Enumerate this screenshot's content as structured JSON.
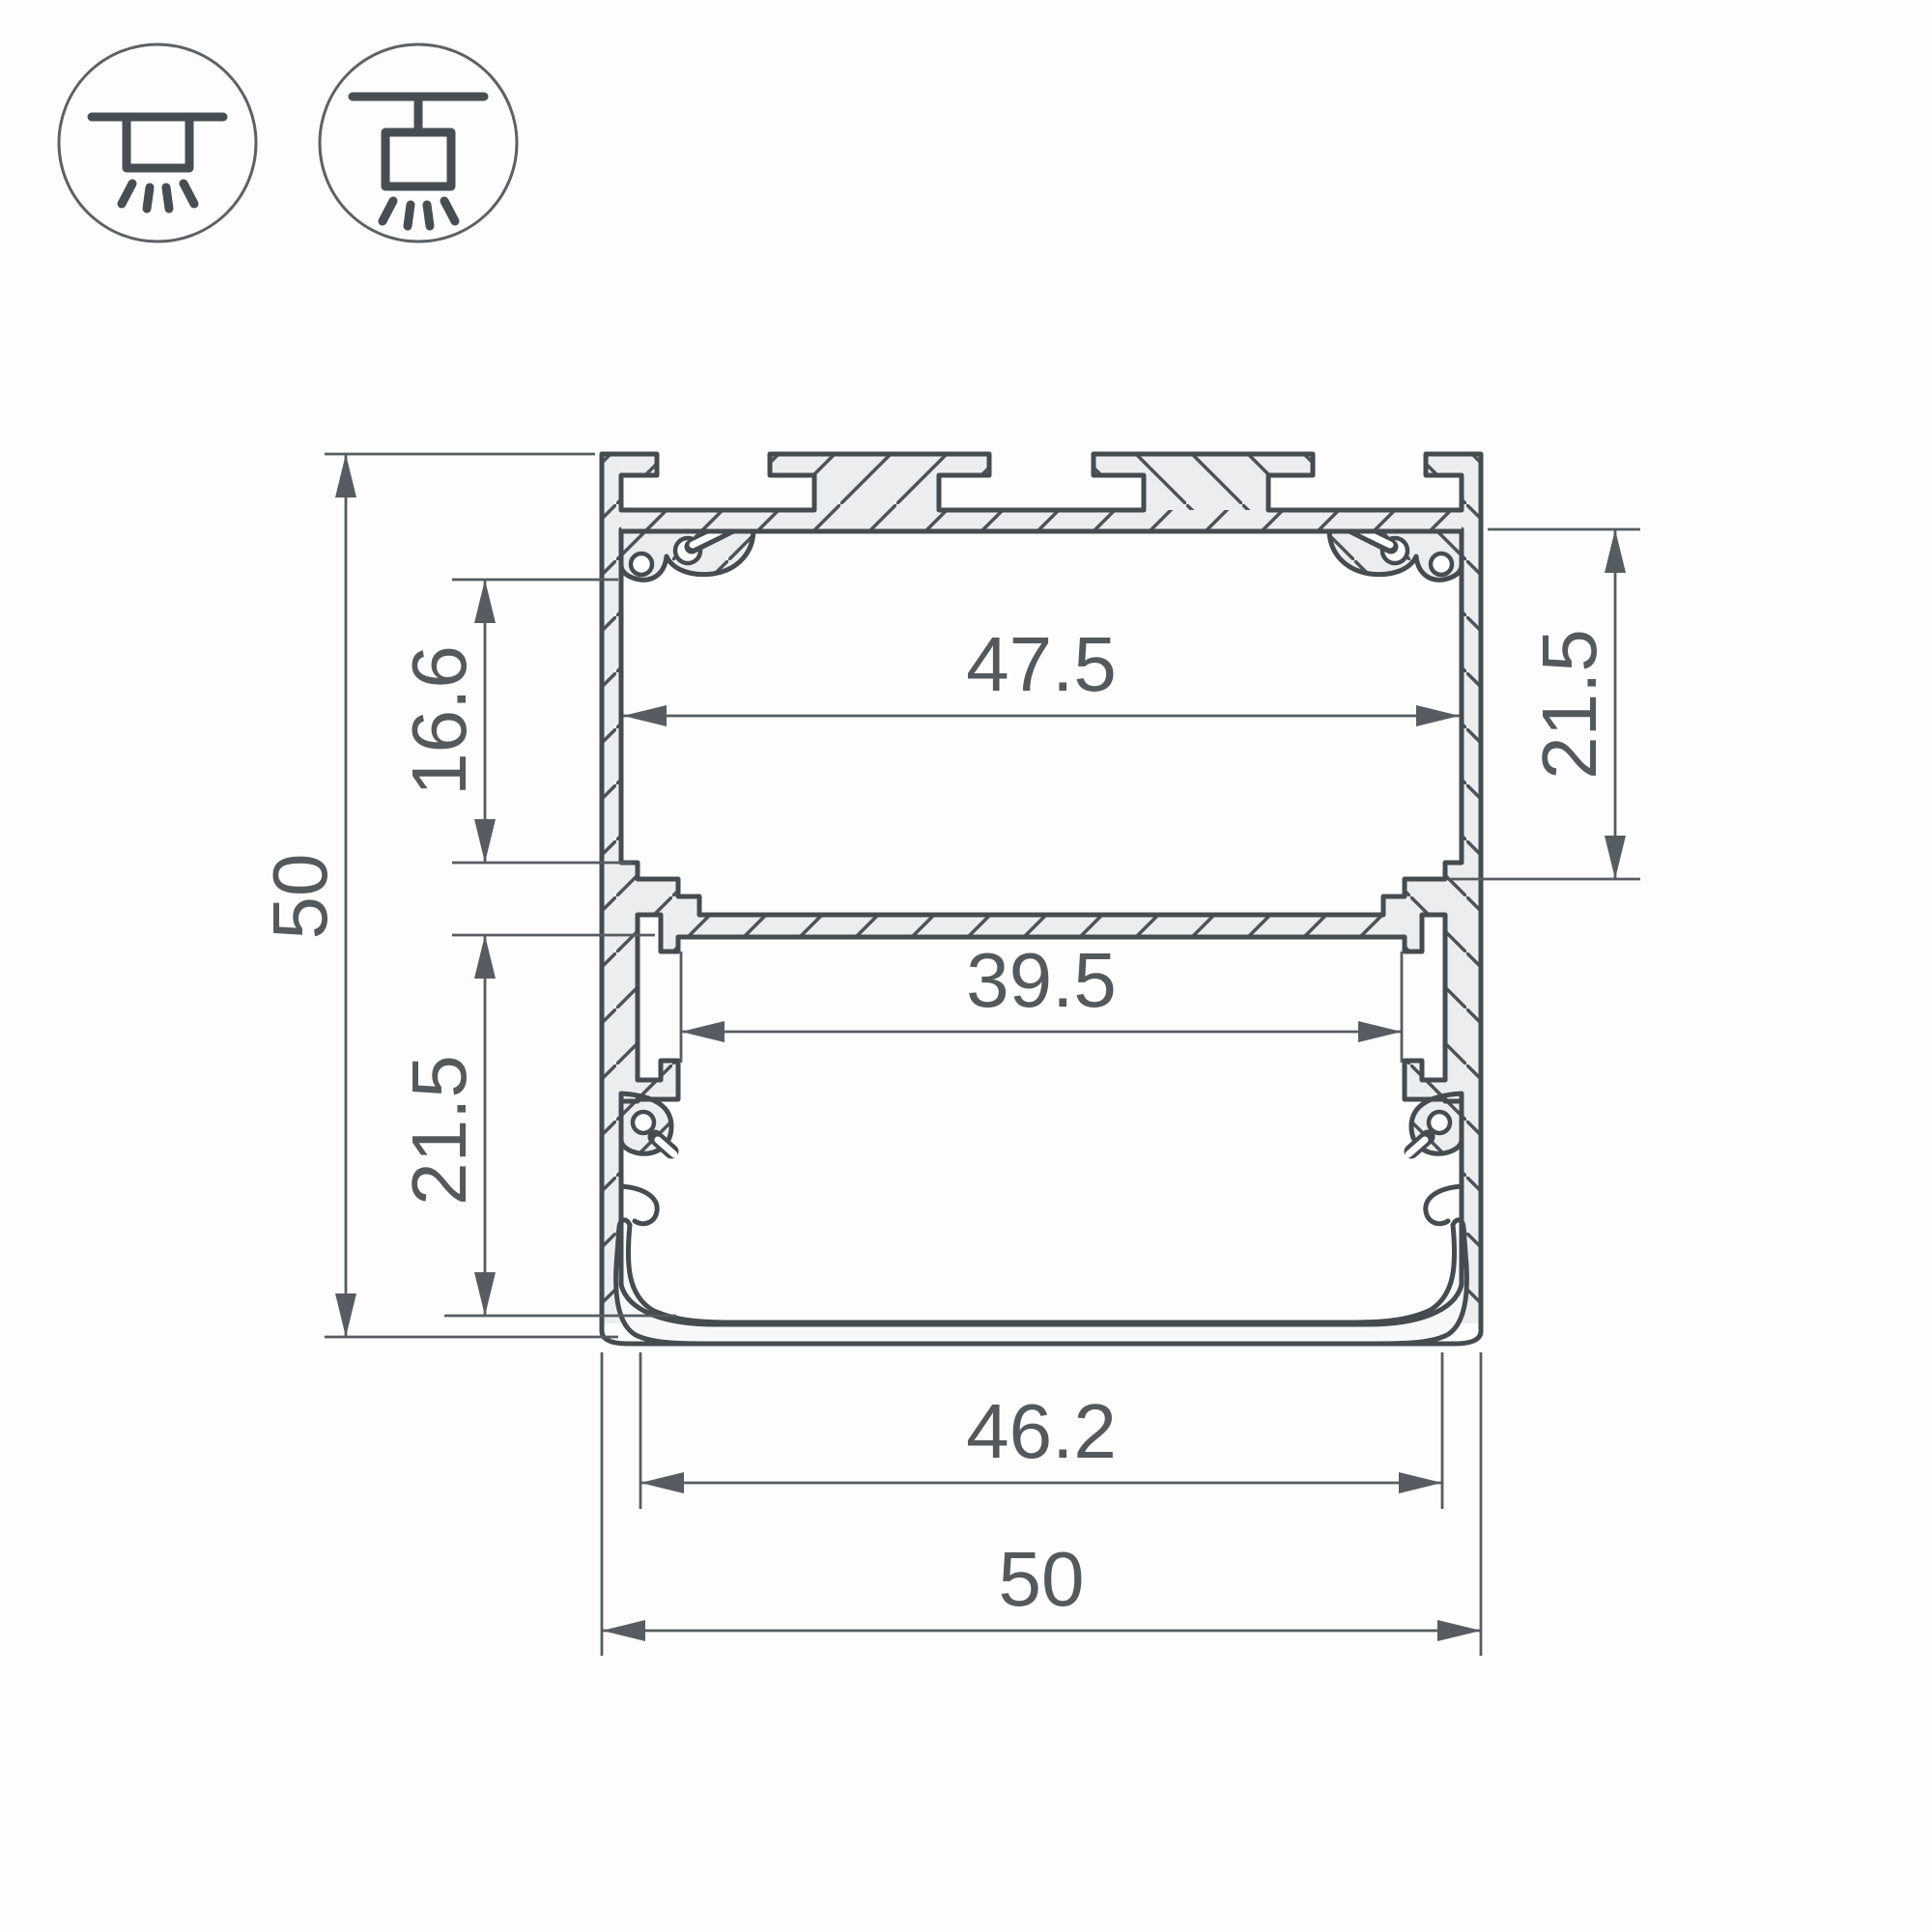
{
  "drawing": {
    "title": "aluminium-led-profile-cross-section",
    "dims": {
      "overall_height": "50",
      "upper_chamber_height": "16.6",
      "lower_chamber_height": "21.5",
      "upper_inner_width": "47.5",
      "right_chamber_height": "21.5",
      "mid_opening_width": "39.5",
      "bottom_opening_width": "46.2",
      "overall_width": "50"
    },
    "icons": [
      {
        "name": "surface-mount-icon",
        "meaning": "ceiling surface mounted luminaire"
      },
      {
        "name": "pendant-mount-icon",
        "meaning": "suspended pendant luminaire"
      }
    ],
    "colors": {
      "outline": "#454c51",
      "dimension": "#565c61",
      "text": "#53595d",
      "material_fill": "#ecedee",
      "background": "#fdfdfd"
    }
  }
}
